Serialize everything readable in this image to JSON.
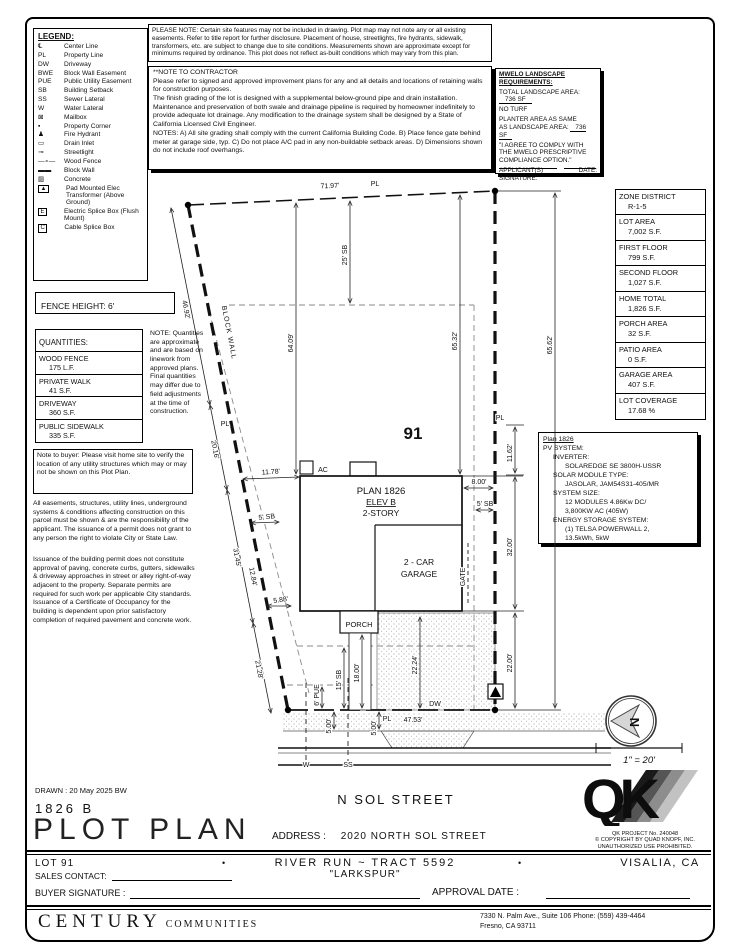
{
  "legend": {
    "title": "LEGEND:",
    "items": [
      {
        "sym": "℄",
        "label": "Center Line"
      },
      {
        "sym": "PL",
        "label": "Property Line"
      },
      {
        "sym": "DW",
        "label": "Driveway"
      },
      {
        "sym": "BWE",
        "label": "Block Wall Easement"
      },
      {
        "sym": "PUE",
        "label": "Public Utility Easement"
      },
      {
        "sym": "SB",
        "label": "Building Setback"
      },
      {
        "sym": "SS",
        "label": "Sewer Lateral"
      },
      {
        "sym": "W",
        "label": "Water Lateral"
      },
      {
        "sym": "⊠",
        "label": "Mailbox"
      },
      {
        "sym": "▪",
        "label": "Property Corner"
      },
      {
        "sym": "♟",
        "label": "Fire Hydrant"
      },
      {
        "sym": "▭",
        "label": "Drain Inlet"
      },
      {
        "sym": "⊸",
        "label": "Streetlight"
      },
      {
        "sym": "—∘—",
        "label": "Wood Fence"
      },
      {
        "sym": "▬▬",
        "label": "Block Wall"
      },
      {
        "sym": "▨",
        "label": "Concrete"
      },
      {
        "sym": "▲",
        "label": "Pad Mounted Elec Transformer (Above Ground)"
      },
      {
        "sym": "E",
        "label": "Electric Splice Box (Flush Mount)"
      },
      {
        "sym": "C",
        "label": "Cable Splice Box"
      }
    ]
  },
  "please_note": "PLEASE NOTE:  Certain site features may not be included in drawing.  Plot map may not note any or all existing easements. Refer to title report for further disclosure.  Placement of house, streetlights, fire hydrants, sidewalk, transformers, etc. are subject to change due to site conditions.  Measurements shown are approximate except for minimums required by ordinance.  This plot does not reflect as-built conditions which may vary from this plan.",
  "contractor_note": {
    "title": "**NOTE TO CONTRACTOR",
    "p1": "Please refer to signed and approved improvement plans for any and all details and locations of retaining walls for construction purposes.",
    "p2": "The finish grading of the lot is designed with a supplemental below-ground pipe and drain installation.  Maintenance and preservation of both swale and drainage pipeline is required by homeowner indefinitely to provide adequate lot drainage.  Any modification to the drainage system shall be designed by a State of California Licensed Civil Engineer.",
    "p3": "NOTES:  A) All site grading shall comply with the current California Building Code. B) Place fence gate behind meter at garage side, typ.  C) Do not place A/C pad in any non-buildable setback areas.  D) Dimensions shown do not include roof overhangs."
  },
  "mwelo": {
    "title": "MWELO LANDSCAPE REQUIREMENTS:",
    "total_label": "TOTAL LANDSCAPE AREA:",
    "total_value": "736 SF",
    "no_turf": "NO TURF",
    "planter_l1": "PLANTER AREA AS SAME",
    "planter_l2": "AS LANDSCAPE AREA:",
    "planter_value": "736 SF",
    "quote": "\"I AGREE TO COMPLY WITH THE MWELO PRESCRIPTIVE COMPLIANCE OPTION.\"",
    "sig_label": "APPLICANT(S) SIGNATURE:",
    "date_label": "DATE:"
  },
  "fence_height": "FENCE HEIGHT: 6'",
  "quantities": {
    "title": "QUANTITIES:",
    "items": [
      {
        "name": "WOOD FENCE",
        "value": "175 L.F."
      },
      {
        "name": "PRIVATE WALK",
        "value": "41 S.F."
      },
      {
        "name": "DRIVEWAY",
        "value": "360 S.F."
      },
      {
        "name": "PUBLIC SIDEWALK",
        "value": "335 S.F."
      }
    ]
  },
  "side_note": "NOTE: Quantities are approximate and are based on linework from approved plans.  Final quantities may differ due to field adjustments at the time of construction.",
  "buyer_note": "Note to buyer: Please visit home site to verify the location of any utility structures which may or may not be shown on this Plot Plan.",
  "easement_note": "All easements, structures, utility lines, underground systems & conditions affecting construction on this parcel must be shown & are the responsibility of the applicant. The issuance of a permit does not grant to any person the right to violate City or State Law.",
  "permit_note": "Issuance of the building permit does not constitute approval of paving, concrete curbs, gutters, sidewalks & driveway approaches in street or alley right-of-way adjacent to the property. Separate permits are required for such work per applicable City standards. Issuance of a Certificate of Occupancy for the building is dependent upon prior satisfactory completion of required pavement and concrete work.",
  "stats": [
    {
      "label": "ZONE DISTRICT",
      "value": "R-1-5"
    },
    {
      "label": "LOT AREA",
      "value": "7,002 S.F."
    },
    {
      "label": "FIRST FLOOR",
      "value": "799 S.F."
    },
    {
      "label": "SECOND FLOOR",
      "value": "1,027 S.F."
    },
    {
      "label": "HOME TOTAL",
      "value": "1,826 S.F."
    },
    {
      "label": "PORCH AREA",
      "value": "32 S.F."
    },
    {
      "label": "PATIO AREA",
      "value": "0 S.F."
    },
    {
      "label": "GARAGE AREA",
      "value": "407 S.F."
    },
    {
      "label": "LOT COVERAGE",
      "value": "17.68 %"
    }
  ],
  "pv": {
    "title": "Plan 1826",
    "l1": "PV SYSTEM:",
    "l2": "INVERTER:",
    "l3": "SOLAREDGE SE 3800H-USSR",
    "l4": "SOLAR MODULE TYPE:",
    "l5": "JASOLAR, JAM54S31-405/MR",
    "l6": "SYSTEM SIZE:",
    "l7": "12 MODULES 4.86Kw DC/",
    "l8": "3,800KW AC (405W)",
    "l9": "ENERGY STORAGE SYSTEM:",
    "l10": "(1) TELSA POWERWALL 2,",
    "l11": "13.5kWh, 5kW"
  },
  "drawing": {
    "lot_number": "91",
    "plan_name": "PLAN 1826",
    "elev": "ELEV B",
    "story": "2-STORY",
    "garage_l1": "2 - CAR",
    "garage_l2": "GARAGE",
    "porch": "PORCH",
    "gate": "GATE",
    "ac": "AC",
    "dw": "DW",
    "w": "W",
    "ss": "SS",
    "street": "N SOL STREET",
    "block_wall": "BLOCK WALL",
    "pl": "PL",
    "dims": {
      "d7197": "71.97'",
      "sb25": "25' SB",
      "d6409": "64.09'",
      "d6532": "65.32'",
      "d6562": "65.62'",
      "d4692": "46.92'",
      "d2016": "20.16'",
      "d3145": "31.45'",
      "d2128": "21.28'",
      "d1178": "11.78'",
      "sb5l": "5' SB",
      "d1284": "12.84'",
      "d588": "5.88'",
      "d800": "8.00'",
      "sb5r": "5' SB",
      "d1162": "11.62'",
      "d3200": "32.00'",
      "d2200": "22.00'",
      "sb15": "15' SB",
      "pue6": "6' PUE",
      "d1800": "18.00'",
      "d2224": "22.24'",
      "d4753": "47.53'",
      "d500a": "5.00'",
      "d500b": "5.00'"
    }
  },
  "footer": {
    "drawn": "DRAWN :  20 May 2025  BW",
    "plan_code": "1826  B",
    "sheet_title": "PLOT PLAN",
    "address_label": "ADDRESS :",
    "address": "2020 NORTH SOL STREET",
    "lot": "LOT 91",
    "bullet": "•",
    "tract": "RIVER RUN ~ TRACT 5592",
    "community": "\"LARKSPUR\"",
    "city": "VISALIA, CA",
    "sales_label": "SALES CONTACT:",
    "buyer_label": "BUYER SIGNATURE :",
    "approval_label": "APPROVAL DATE :",
    "brand_main": "CENTURY",
    "brand_sub": "COMMUNITIES",
    "office_line1": "7330 N. Palm Ave., Suite 106    Phone:  (559) 439-4464",
    "office_line2": "Fresno, CA  93711",
    "scale": "1\" = 20'",
    "north": "N",
    "qk": "QK",
    "qk_project": "QK PROJECT No. 240048",
    "qk_copy1": "© COPYRIGHT BY QUAD KNOPF, INC.",
    "qk_copy2": "UNAUTHORIZED USE PROHIBITED."
  }
}
